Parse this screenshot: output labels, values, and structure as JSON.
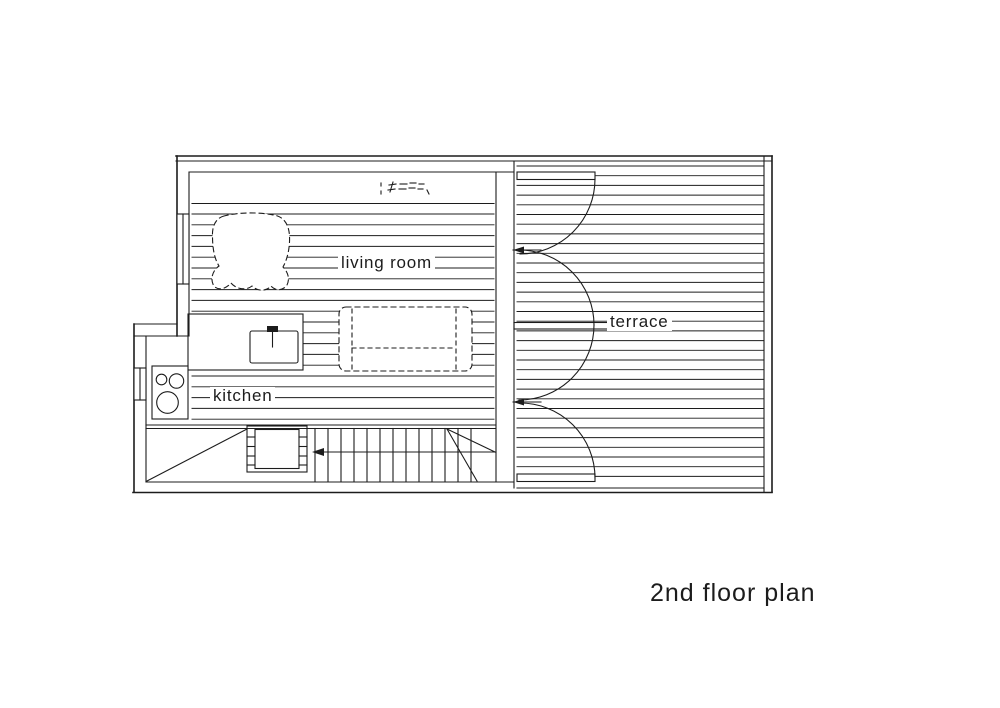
{
  "page": {
    "background": "#ffffff",
    "line_color": "#1c1c1c"
  },
  "title": "2nd floor plan",
  "rooms": {
    "living_room": "living room",
    "kitchen": "kitchen",
    "terrace": "terrace"
  }
}
